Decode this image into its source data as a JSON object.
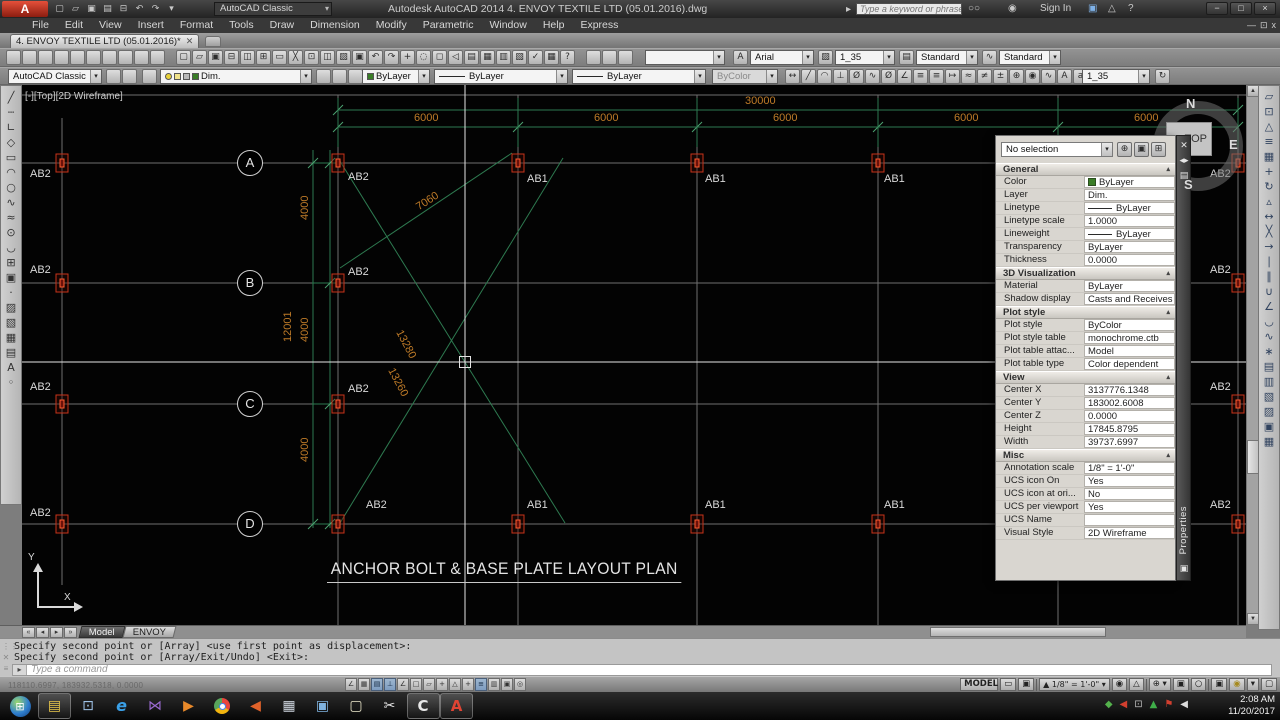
{
  "window": {
    "logo": "A",
    "full_title": "Autodesk AutoCAD 2014   4. ENVOY TEXTILE LTD (05.01.2016).dwg",
    "workspace": "AutoCAD Classic",
    "search_placeholder": "Type a keyword or phrase",
    "sign_in": "Sign In"
  },
  "menu": [
    "File",
    "Edit",
    "View",
    "Insert",
    "Format",
    "Tools",
    "Draw",
    "Dimension",
    "Modify",
    "Parametric",
    "Window",
    "Help",
    "Express"
  ],
  "file_tab": "4. ENVOY TEXTILE LTD (05.01.2016)*",
  "toolbars": {
    "workspace": "AutoCAD Classic",
    "font": "Arial",
    "text_style": "1_35",
    "table_style": "Standard",
    "multileader_style": "Standard",
    "layer": "Dim.",
    "color": "ByLayer",
    "linetype": "ByLayer",
    "lineweight": "ByLayer",
    "plot_style": "ByColor",
    "dim_style": "1_35"
  },
  "icon_sets": {
    "qat": [
      "qnew",
      "open",
      "save",
      "save-as",
      "plot",
      "undo",
      "redo",
      "qat-dropdown"
    ],
    "row1_left": [
      "standards-check",
      "layer-translate",
      "cad-standards",
      "dim-update-tool",
      "annotate-a",
      "annotate-b",
      "rotate-view",
      "named-views",
      "lock-position",
      "unlock-position"
    ],
    "standard": [
      "qnew",
      "open",
      "save",
      "plot",
      "preview",
      "publish",
      "dwf",
      "cut",
      "copy",
      "paste",
      "match-properties",
      "block-editor",
      "undo",
      "redo",
      "pan",
      "zoom-realtime",
      "zoom-window",
      "zoom-previous",
      "properties",
      "design-center",
      "tool-palettes",
      "sheet-set-manager",
      "markup",
      "quickcalc",
      "help"
    ],
    "row1_mid": [
      "viewport-single",
      "viewport-poly",
      "viewport-join"
    ],
    "layer_left": [
      "layer-properties"
    ],
    "layer_right": [
      "make-object-layer-current",
      "layer-previous",
      "layer-states"
    ],
    "row2_left_tools": [
      "workspace-settings",
      "my-workspace"
    ],
    "dimension": [
      "dim-linear",
      "dim-aligned",
      "dim-arc-length",
      "dim-ordinate",
      "dim-radius",
      "dim-jogged",
      "dim-diameter",
      "dim-angular",
      "dim-quick",
      "dim-baseline",
      "dim-continue",
      "dim-space",
      "dim-break",
      "dim-tolerance",
      "dim-center-mark",
      "dim-inspect",
      "dim-jog-line",
      "dim-edit",
      "dim-text-edit"
    ],
    "dim_end": [
      "dim-update"
    ],
    "draw": [
      "line",
      "construction-line",
      "polyline",
      "polygon",
      "rectangle",
      "arc",
      "circle",
      "revision-cloud",
      "spline",
      "ellipse",
      "ellipse-arc",
      "insert-block",
      "make-block",
      "point",
      "hatch",
      "gradient",
      "region",
      "table",
      "mtext",
      "add-selected"
    ],
    "modify": [
      "erase",
      "copy",
      "mirror",
      "offset",
      "array",
      "move",
      "rotate",
      "scale",
      "stretch",
      "trim",
      "extend",
      "break-at-point",
      "break",
      "join",
      "chamfer",
      "fillet",
      "blend-curves",
      "explode",
      "bring-to-front",
      "send-to-back",
      "bring-above",
      "send-under",
      "draworder-annotations",
      "draworder-hatch"
    ],
    "status_toggles": [
      "infer",
      "snap",
      "grid",
      "ortho",
      "polar",
      "osnap",
      "osnap-3d",
      "otrack",
      "ducs",
      "dyn",
      "lwt",
      "tpy",
      "qp",
      "sc"
    ],
    "palette_header": [
      "quick-select",
      "select-objects",
      "toggle-pickadd"
    ],
    "tray": [
      "safely-remove",
      "kmplayer-tray",
      "display-tray",
      "update-tray",
      "flag-tray",
      "volume-tray"
    ]
  },
  "plan": {
    "viewport_label": "[-][Top][2D Wireframe]",
    "title": "ANCHOR BOLT & BASE PLATE LAYOUT PLAN",
    "compass": {
      "n": "N",
      "e": "E",
      "s": "S",
      "face": "TOP"
    },
    "ucs": {
      "x_label": "X",
      "y_label": "Y"
    },
    "bubbles": [
      "A",
      "B",
      "C",
      "D"
    ],
    "bubble_x": 250,
    "row_y": [
      163,
      283,
      404,
      524
    ],
    "col_x": [
      338,
      518,
      697,
      878,
      1058,
      1238
    ],
    "bolts": [
      [
        62,
        163
      ],
      [
        338,
        163
      ],
      [
        518,
        163
      ],
      [
        697,
        163
      ],
      [
        878,
        163
      ],
      [
        1058,
        163
      ],
      [
        1238,
        163
      ],
      [
        62,
        283
      ],
      [
        338,
        283
      ],
      [
        1238,
        283
      ],
      [
        62,
        404
      ],
      [
        338,
        404
      ],
      [
        1238,
        404
      ],
      [
        62,
        524
      ],
      [
        338,
        524
      ],
      [
        518,
        524
      ],
      [
        697,
        524
      ],
      [
        878,
        524
      ],
      [
        1058,
        524
      ],
      [
        1238,
        524
      ]
    ],
    "bolt_labels": [
      {
        "t": "AB2",
        "x": 30,
        "y": 168
      },
      {
        "t": "AB2",
        "x": 348,
        "y": 171
      },
      {
        "t": "AB1",
        "x": 527,
        "y": 173
      },
      {
        "t": "AB1",
        "x": 705,
        "y": 173
      },
      {
        "t": "AB1",
        "x": 884,
        "y": 173
      },
      {
        "t": "AB2",
        "x": 1210,
        "y": 168
      },
      {
        "t": "AB2",
        "x": 30,
        "y": 264
      },
      {
        "t": "AB2",
        "x": 348,
        "y": 266
      },
      {
        "t": "AB2",
        "x": 1210,
        "y": 264
      },
      {
        "t": "AB2",
        "x": 30,
        "y": 381
      },
      {
        "t": "AB2",
        "x": 348,
        "y": 383
      },
      {
        "t": "AB2",
        "x": 1210,
        "y": 381
      },
      {
        "t": "AB2",
        "x": 30,
        "y": 507
      },
      {
        "t": "AB2",
        "x": 366,
        "y": 499
      },
      {
        "t": "AB1",
        "x": 527,
        "y": 499
      },
      {
        "t": "AB1",
        "x": 705,
        "y": 499
      },
      {
        "t": "AB1",
        "x": 884,
        "y": 499
      },
      {
        "t": "AB2",
        "x": 1210,
        "y": 499
      }
    ],
    "dims": {
      "total": {
        "t": "30000",
        "x": 745,
        "y": 95
      },
      "bays": [
        {
          "t": "6000",
          "x": 428
        },
        {
          "t": "6000",
          "x": 608
        },
        {
          "t": "6000",
          "x": 787
        },
        {
          "t": "6000",
          "x": 968
        },
        {
          "t": "6000",
          "x": 1148
        }
      ],
      "bay_y": 112,
      "verticals": [
        {
          "t": "12001",
          "x": 282,
          "y": 342
        },
        {
          "t": "4000",
          "x": 299,
          "y": 220
        },
        {
          "t": "4000",
          "x": 299,
          "y": 342
        },
        {
          "t": "4000",
          "x": 299,
          "y": 462
        }
      ],
      "diagonals": [
        {
          "t": "7060",
          "x": 414,
          "y": 203,
          "r": -33
        },
        {
          "t": "13280",
          "x": 404,
          "y": 328,
          "r": 62
        },
        {
          "t": "13260",
          "x": 396,
          "y": 366,
          "r": 62
        }
      ]
    }
  },
  "properties": {
    "selection": "No selection",
    "tab": "Properties",
    "sections": [
      {
        "title": "General",
        "rows": [
          {
            "label": "Color",
            "value": "ByLayer",
            "kind": "swatch"
          },
          {
            "label": "Layer",
            "value": "Dim."
          },
          {
            "label": "Linetype",
            "value": "ByLayer",
            "kind": "line"
          },
          {
            "label": "Linetype scale",
            "value": "1.0000"
          },
          {
            "label": "Lineweight",
            "value": "ByLayer",
            "kind": "line"
          },
          {
            "label": "Transparency",
            "value": "ByLayer"
          },
          {
            "label": "Thickness",
            "value": "0.0000"
          }
        ]
      },
      {
        "title": "3D Visualization",
        "rows": [
          {
            "label": "Material",
            "value": "ByLayer"
          },
          {
            "label": "Shadow display",
            "value": "Casts and Receives ..."
          }
        ]
      },
      {
        "title": "Plot style",
        "rows": [
          {
            "label": "Plot style",
            "value": "ByColor"
          },
          {
            "label": "Plot style table",
            "value": "monochrome.ctb"
          },
          {
            "label": "Plot table attac...",
            "value": "Model"
          },
          {
            "label": "Plot table type",
            "value": "Color dependent"
          }
        ]
      },
      {
        "title": "View",
        "rows": [
          {
            "label": "Center X",
            "value": "3137776.1348"
          },
          {
            "label": "Center Y",
            "value": "183002.6008"
          },
          {
            "label": "Center Z",
            "value": "0.0000"
          },
          {
            "label": "Height",
            "value": "17845.8795"
          },
          {
            "label": "Width",
            "value": "39737.6997"
          }
        ]
      },
      {
        "title": "Misc",
        "rows": [
          {
            "label": "Annotation scale",
            "value": "1/8\" = 1'-0\""
          },
          {
            "label": "UCS icon On",
            "value": "Yes"
          },
          {
            "label": "UCS icon at ori...",
            "value": "No"
          },
          {
            "label": "UCS per viewport",
            "value": "Yes"
          },
          {
            "label": "UCS Name",
            "value": ""
          },
          {
            "label": "Visual Style",
            "value": "2D Wireframe"
          }
        ]
      }
    ]
  },
  "layout_tabs": [
    "Model",
    "ENVOY"
  ],
  "command": {
    "history": [
      "Specify second point or [Array] <use first point as displacement>:",
      "Specify second point or [Array/Exit/Undo] <Exit>:"
    ],
    "prompt": "Type a command"
  },
  "status": {
    "coords": "118110.6997, 183932.5318, 0.0000",
    "model_label": "MODEL",
    "annotation_scale": "1/8\" = 1'-0\"",
    "time": "2:08 AM",
    "date": "11/20/2017"
  },
  "taskbar": {
    "apps": [
      "start",
      "file-explorer",
      "remote-viewer",
      "internet-explorer",
      "kmplayer",
      "media-player",
      "chrome",
      "volume-app",
      "calculator",
      "photo-viewer",
      "sticky-notes",
      "snipping-tool",
      "camtasia",
      "autocad"
    ]
  }
}
